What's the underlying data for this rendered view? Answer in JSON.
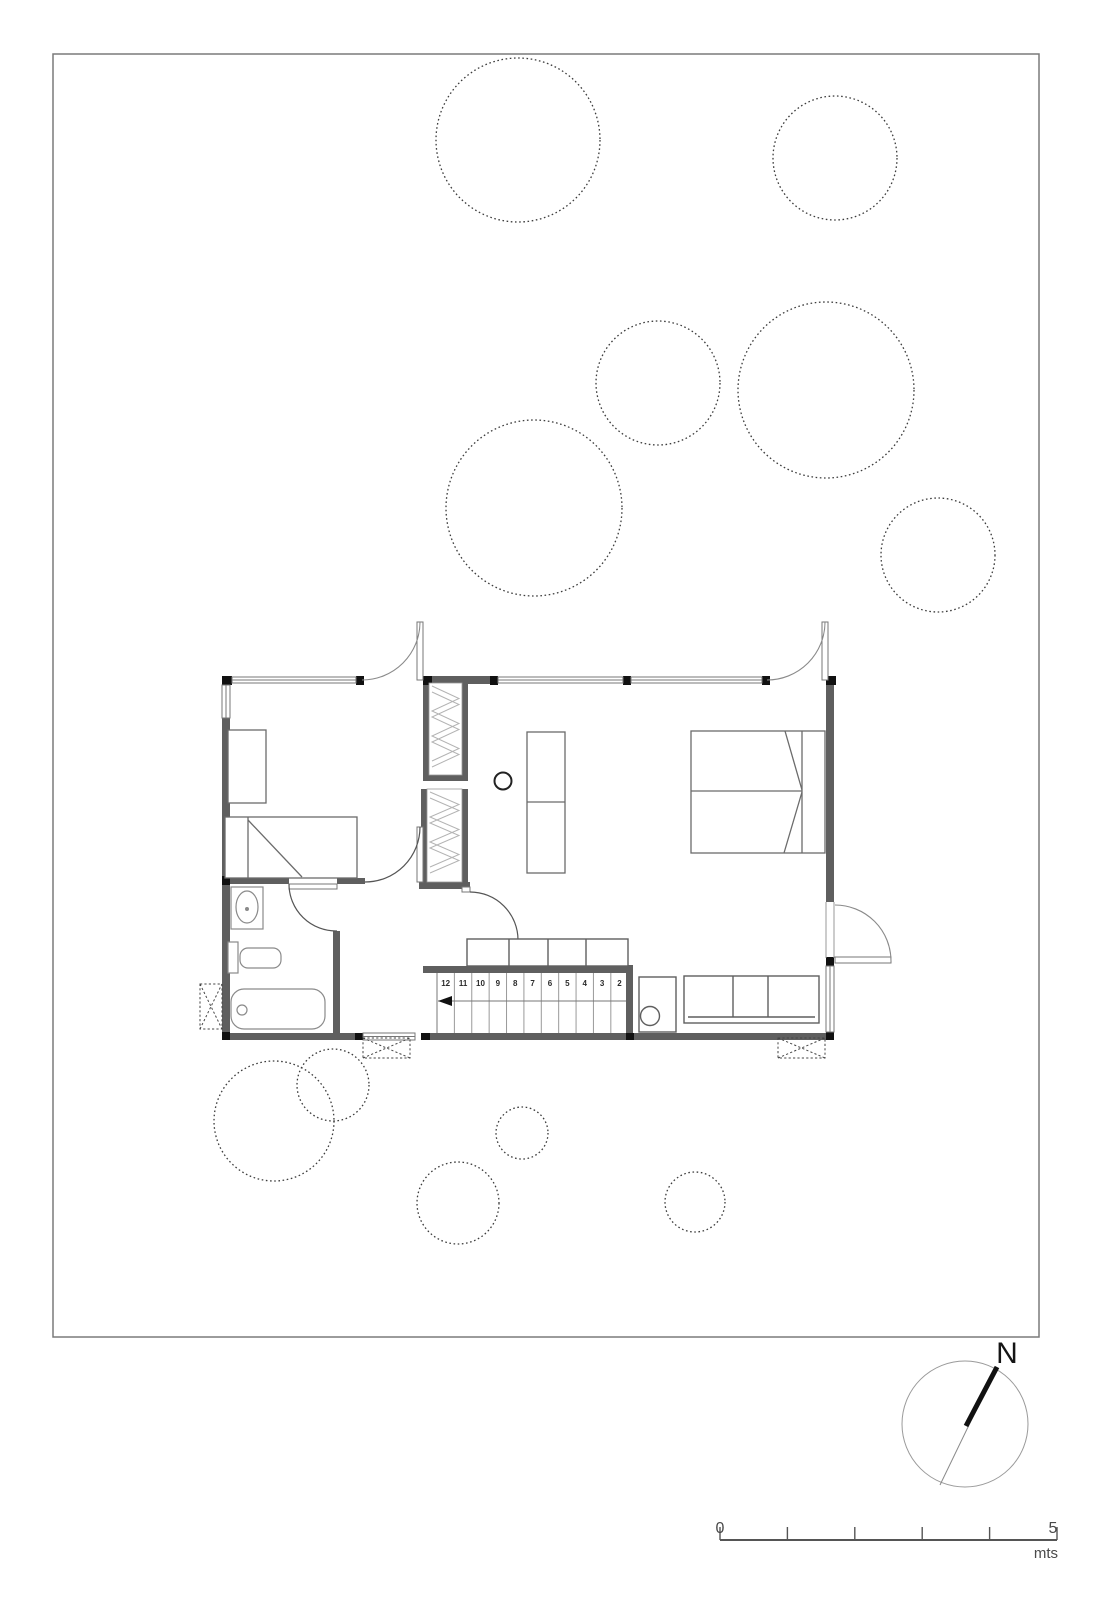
{
  "compass": {
    "north_label": "N"
  },
  "scale_bar": {
    "start_label": "0",
    "end_label": "5",
    "unit_label": "mts"
  },
  "stairs": {
    "steps": [
      "12",
      "11",
      "10",
      "9",
      "8",
      "7",
      "6",
      "5",
      "4",
      "3",
      "2"
    ]
  },
  "trees": [
    {
      "cx": 518,
      "cy": 140,
      "r": 82
    },
    {
      "cx": 835,
      "cy": 158,
      "r": 62
    },
    {
      "cx": 658,
      "cy": 383,
      "r": 62
    },
    {
      "cx": 826,
      "cy": 390,
      "r": 88
    },
    {
      "cx": 534,
      "cy": 508,
      "r": 88
    },
    {
      "cx": 938,
      "cy": 555,
      "r": 57
    },
    {
      "cx": 274,
      "cy": 1121,
      "r": 60
    },
    {
      "cx": 333,
      "cy": 1085,
      "r": 36
    },
    {
      "cx": 522,
      "cy": 1133,
      "r": 26
    },
    {
      "cx": 458,
      "cy": 1203,
      "r": 41
    },
    {
      "cx": 695,
      "cy": 1202,
      "r": 30
    }
  ],
  "colors": {
    "wall": "#5f5f5f",
    "column": "#111111",
    "window_line": "#777777",
    "furniture_line": "#6b6b6b",
    "fixture_line": "#8a8a8a",
    "tree_line": "#3c3c3c",
    "site_border": "#7a7a7a",
    "hatch": "#b3b3b3",
    "annotation": "#4a4a4a"
  }
}
